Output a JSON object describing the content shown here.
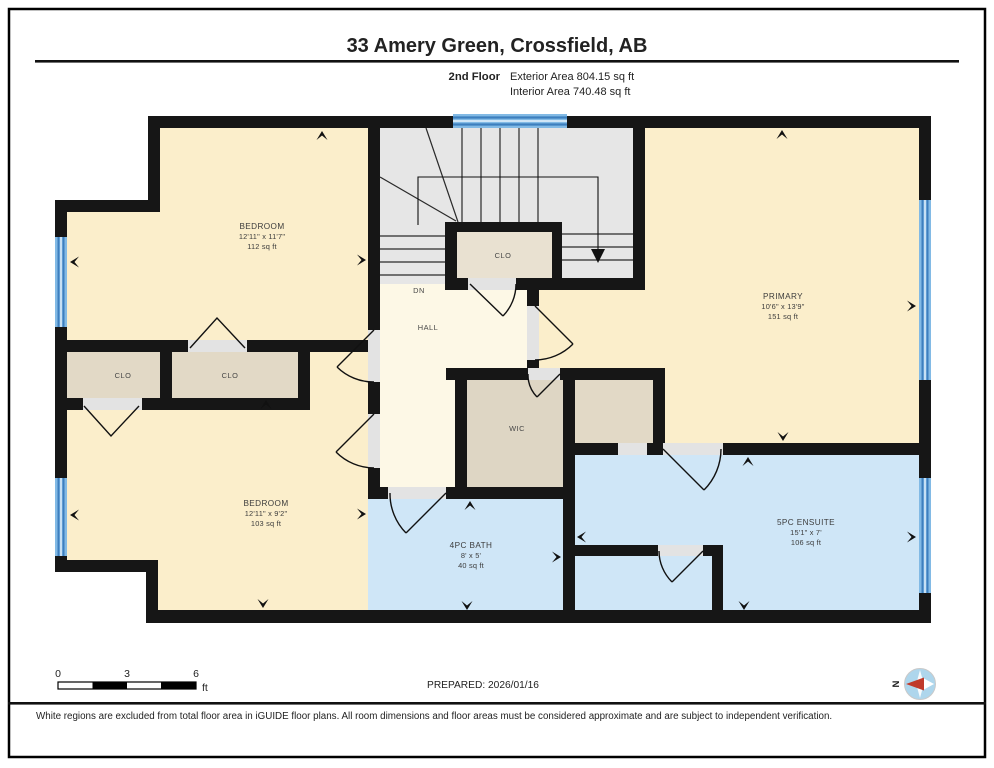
{
  "header": {
    "title": "33 Amery Green, Crossfield, AB",
    "floor_label": "2nd Floor",
    "exterior_area": "Exterior Area 804.15 sq ft",
    "interior_area": "Interior Area 740.48 sq ft"
  },
  "rooms": {
    "bedroom1": {
      "name": "BEDROOM",
      "dims": "12'11\" x 11'7\"",
      "area": "112 sq ft"
    },
    "bedroom2": {
      "name": "BEDROOM",
      "dims": "12'11\" x 9'2\"",
      "area": "103 sq ft"
    },
    "primary": {
      "name": "PRIMARY",
      "dims": "10'6\" x 13'9\"",
      "area": "151 sq ft"
    },
    "ensuite": {
      "name": "5PC ENSUITE",
      "dims": "15'1\" x 7'",
      "area": "106 sq ft"
    },
    "bath": {
      "name": "4PC BATH",
      "dims": "8' x 5'",
      "area": "40 sq ft"
    },
    "wic": {
      "name": "WIC"
    },
    "hall": {
      "name": "HALL"
    },
    "stairs_down": {
      "name": "DN"
    },
    "closet_stairs": {
      "name": "CLO"
    },
    "closet_left": {
      "name": "CLO"
    },
    "closet_right": {
      "name": "CLO"
    }
  },
  "footer": {
    "scale": {
      "zero": "0",
      "three": "3",
      "six": "6",
      "unit": "ft"
    },
    "prepared": "PREPARED: 2026/01/16",
    "compass": "N",
    "disclaimer": "White regions are excluded from total floor area in iGUIDE floor plans. All room dimensions and floor areas must be considered approximate and are subject to independent verification."
  },
  "colors": {
    "wall": "#161616",
    "bedroom_fill": "#fbeecb",
    "hall_fill": "#fdf8e6",
    "closet_fill": "#e2d9c6",
    "wet_room_fill": "#cfe6f7",
    "stairs_fill": "#e6e6e6",
    "window_blue": "#7cb7e4",
    "door_gap": "#e3e3e3",
    "compass_red": "#c03a2b"
  }
}
